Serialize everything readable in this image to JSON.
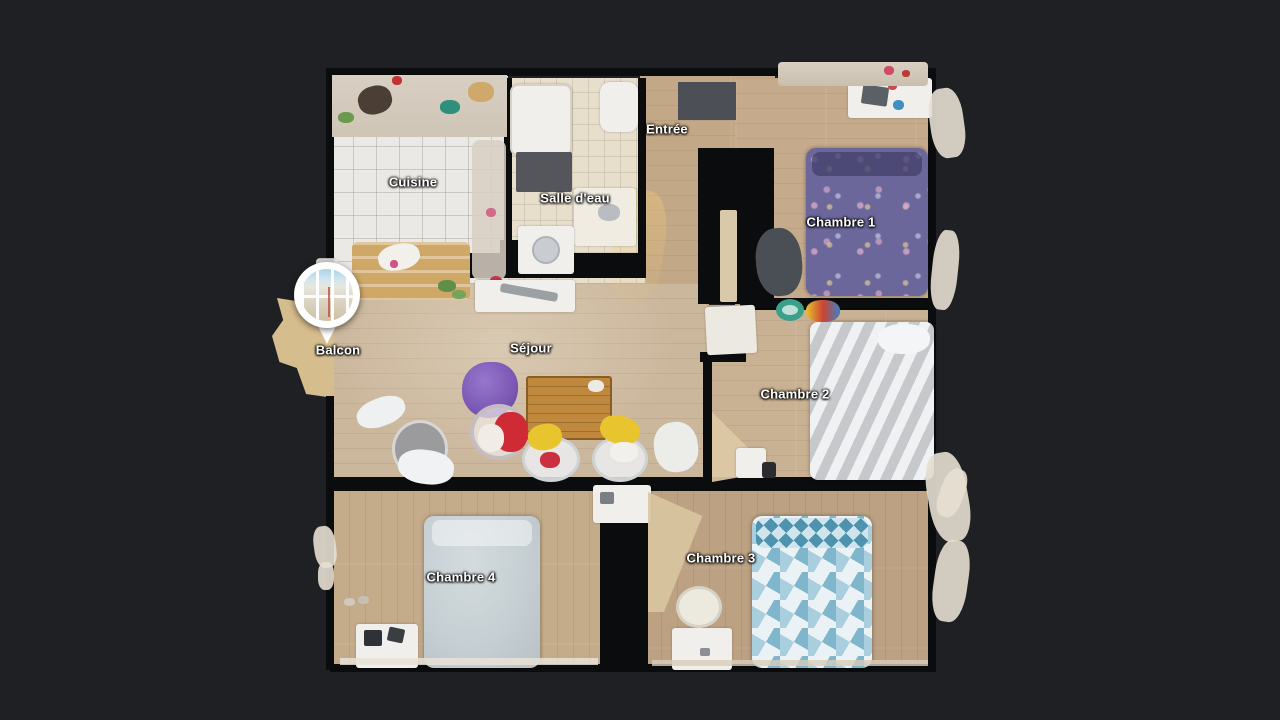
{
  "app": {
    "view": "floorplan-top-down",
    "background_color": "#1e2023"
  },
  "floorplan": {
    "labels": {
      "cuisine": "Cuisine",
      "salle_deau": "Salle d'eau",
      "entree": "Entrée",
      "chambre1": "Chambre 1",
      "chambre2": "Chambre 2",
      "chambre3": "Chambre 3",
      "chambre4": "Chambre 4",
      "sejour": "Séjour",
      "balcon": "Balcon"
    },
    "marker": {
      "type": "viewpoint-pin",
      "room": "balcon"
    },
    "colors": {
      "background": "#1e2023",
      "wall": "#0b0c0e",
      "wood_floor": "#c8b194",
      "wood_floor_dark": "#bca183",
      "kitchen_tile": "#ebe9e5",
      "bath_tile": "#e7dfcc",
      "bed_chambre1": "#6b679b",
      "bed_chambre2": "#d9dadd",
      "bed_chambre3": "#7fb6cc",
      "bed_chambre4": "#c6cfd3",
      "table_wood": "#c0883d",
      "beanbag_purple": "#7b58b4",
      "chair_red": "#cf2b36",
      "chair_yellow": "#e8c52f",
      "marker_ring": "#ffffff",
      "doormat": "#4c4f55"
    }
  }
}
